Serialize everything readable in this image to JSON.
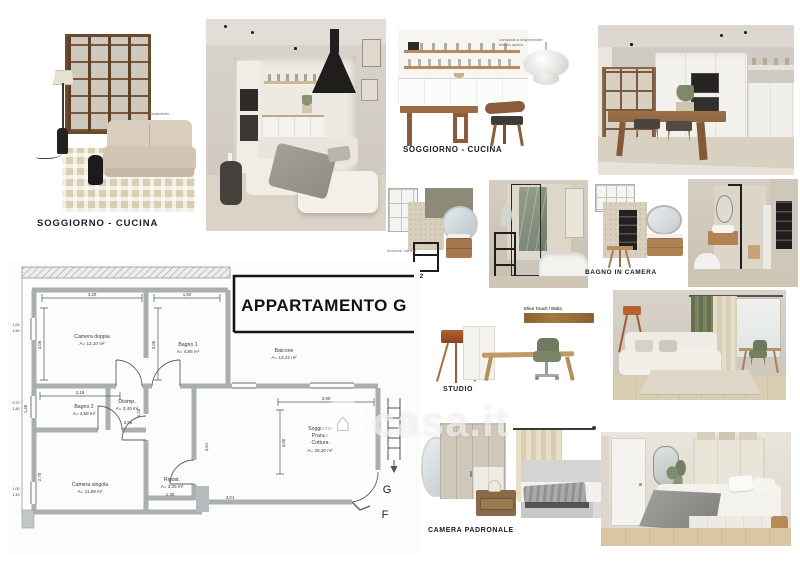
{
  "watermark": {
    "text": "casa.it",
    "icon": "house-in-circle"
  },
  "palette": {
    "wood": "#8a6a4c",
    "sage": "#8b8b77",
    "beige": "#d8d0bd",
    "plan_wall": "#aaafb1",
    "marble_green": "#7d8a77",
    "copper": "#b5622f"
  },
  "tiles": {
    "soggiorno_left": {
      "label": "SOGGIORNO - CUCINA",
      "sofa_note": "Divanoletto"
    },
    "soggiorno_right": {
      "label": "SOGGIORNO - CUCINA",
      "lamp_note_line1": "Lampada a sospensione",
      "lamp_note_line2": "bianco opaco"
    },
    "bagno2": {
      "label": "BAGNO 2",
      "cart_note": "Arredook / carrello"
    },
    "bagno_in_camera": {
      "label": "BAGNO IN CAMERA"
    },
    "studio": {
      "label": "STUDIO",
      "material_note": "Elion Touch / Malta"
    },
    "camera_padronale": {
      "label": "CAMERA PADRONALE"
    }
  },
  "plan": {
    "title": "APPARTAMENTO G",
    "rooms": {
      "camera_doppia": {
        "name": "Camera doppia",
        "area": "A= 13,10 m²"
      },
      "bagno1": {
        "name": "Bagno 1",
        "area": "A= 4,85 m²"
      },
      "balcone": {
        "name": "Balcone",
        "area": "A= 13,22 m²"
      },
      "bagno2": {
        "name": "Bagno 2",
        "area": "A= 4,58 m²"
      },
      "disimp": {
        "name": "Disimp.",
        "area": "A= 3,40 m²"
      },
      "camera_singola": {
        "name": "Camera singola",
        "area": "A= 11,59 m²"
      },
      "ripost": {
        "name": "Ripost.",
        "area": "A= 3,05 m²"
      },
      "soggiorno": {
        "line1": "Soggiorno",
        "line2": "Pranzo",
        "line3": "Cottura",
        "area": "A= 26,20 m²"
      }
    },
    "dims": {
      "d420": "4,20",
      "d192": "1,92",
      "d306a": "3,06",
      "d306b": "3,06",
      "d318": "3,18",
      "d145": "1,45",
      "d296": "2,96",
      "d120": "1,20",
      "d390": "3,90",
      "d360": "3,60",
      "d301": "3,01",
      "d270": "2,70",
      "d135": "1,35",
      "d361": "3,61",
      "w1a": "1,00",
      "w1b": "1,50",
      "w2a": "0,70",
      "w2b": "1,80",
      "w3a": "1,00",
      "w3b": "1,40"
    },
    "markers": {
      "g": "G",
      "f": "F"
    }
  }
}
